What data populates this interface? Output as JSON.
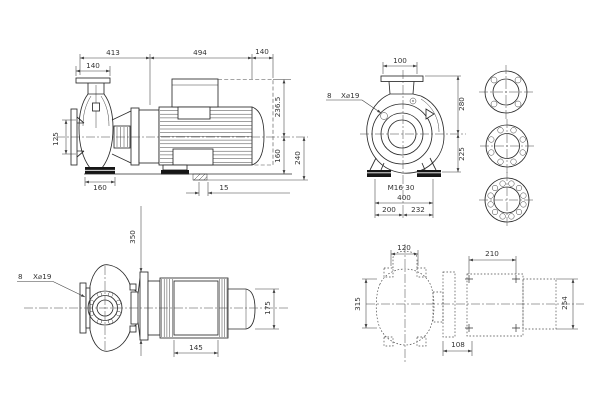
{
  "drawing": {
    "description": "Pump outline dimensional drawing with four orthographic views and flange drilling details",
    "colors": {
      "background": "#ffffff",
      "line": "#2b2b2b",
      "dimension": "#3d3d3d"
    },
    "side_view": {
      "d413": "413",
      "d494": "494",
      "d140_motor": "140",
      "d140_flange": "140",
      "d125": "125",
      "d160_foot": "160",
      "d236_5": "236.5",
      "d160_axis": "160",
      "d240": "240",
      "d15": "15"
    },
    "front_view": {
      "d100": "100",
      "d280": "280",
      "d225": "225",
      "bolt_note": "M16 30",
      "d400": "400",
      "d200": "200",
      "d232": "232",
      "holes_count": "8",
      "holes_spec": "X⌀19"
    },
    "plan_view": {
      "d350": "350",
      "d145": "145",
      "d175": "175",
      "holes_count": "8",
      "holes_spec": "X⌀19"
    },
    "foundation_view": {
      "d120": "120",
      "d210": "210",
      "d315": "315",
      "d108": "108",
      "d254": "254"
    }
  }
}
